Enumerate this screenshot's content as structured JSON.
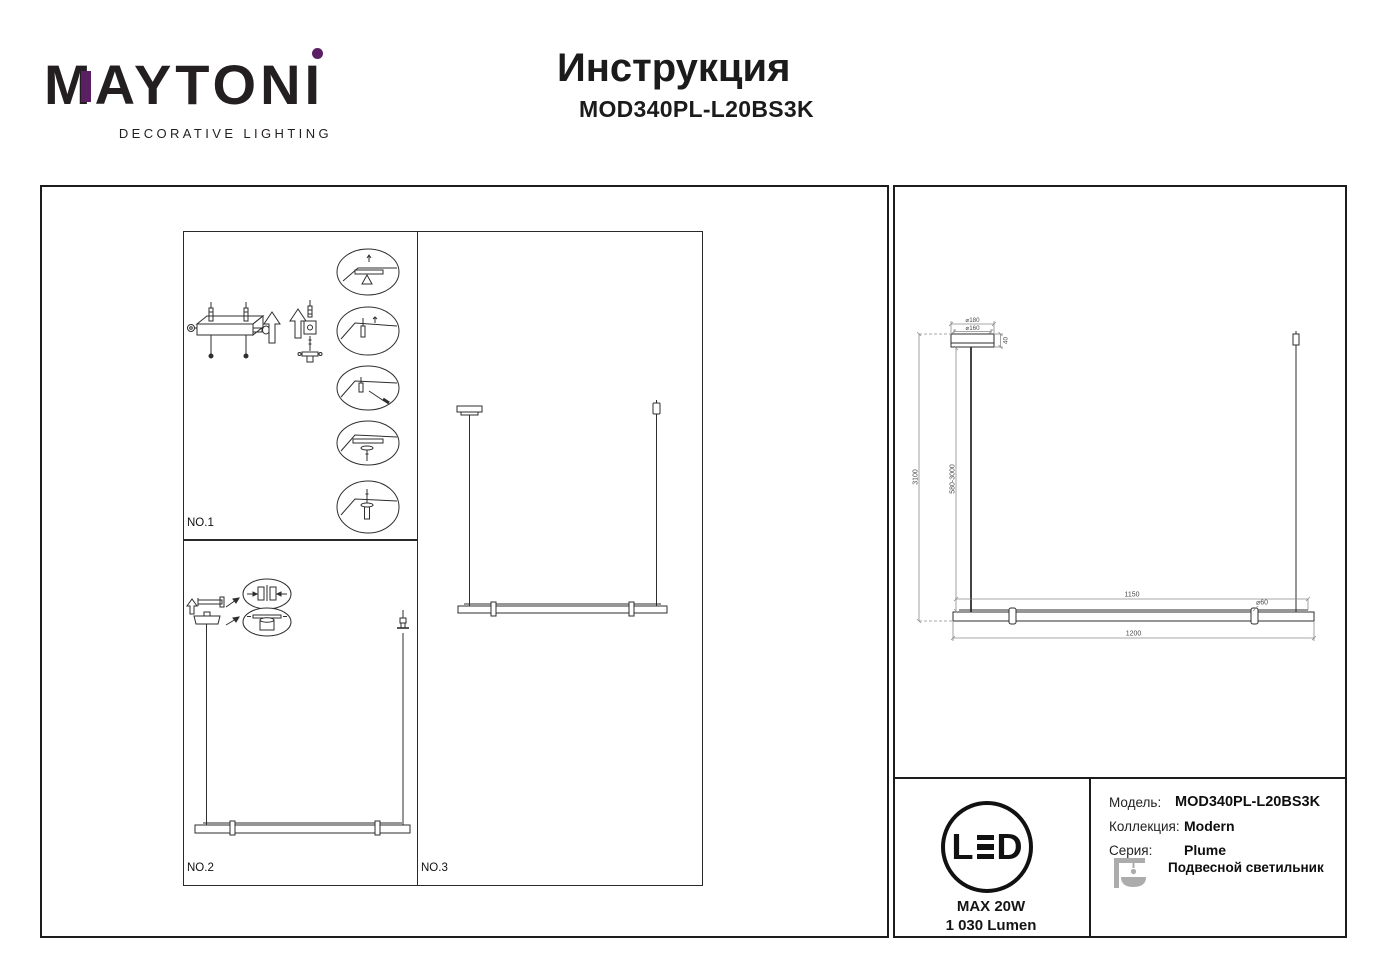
{
  "brand": {
    "logo_m": "M",
    "logo_rest": "AYTON",
    "logo_i": "I",
    "tagline": "DECORATIVE LIGHTING"
  },
  "header": {
    "title": "Инструкция",
    "model": "MOD340PL-L20BS3K"
  },
  "panels": {
    "no1": "NO.1",
    "no2": "NO.2",
    "no3": "NO.3"
  },
  "dimensions": {
    "canopy_diameter_outer": "⌀180",
    "canopy_diameter_inner": "⌀160",
    "canopy_height": "40",
    "overall_height": "3100",
    "suspension_range": "580-3000",
    "span": "1150",
    "tube_diameter": "⌀60",
    "length": "1200"
  },
  "specs": {
    "led_l": "L",
    "led_d": "D",
    "max_power": "MAX 20W",
    "luminous_flux": "1 030 Lumen"
  },
  "info": {
    "model_label": "Модель:",
    "model_value": "MOD340PL-L20BS3K",
    "collection_label": "Коллекция:",
    "collection_value": "Modern",
    "series_label": "Серия:",
    "series_value": "Plume",
    "type_value": "Подвесной светильник"
  },
  "colors": {
    "accent_purple": "#5B2064",
    "ink": "#231F20"
  }
}
